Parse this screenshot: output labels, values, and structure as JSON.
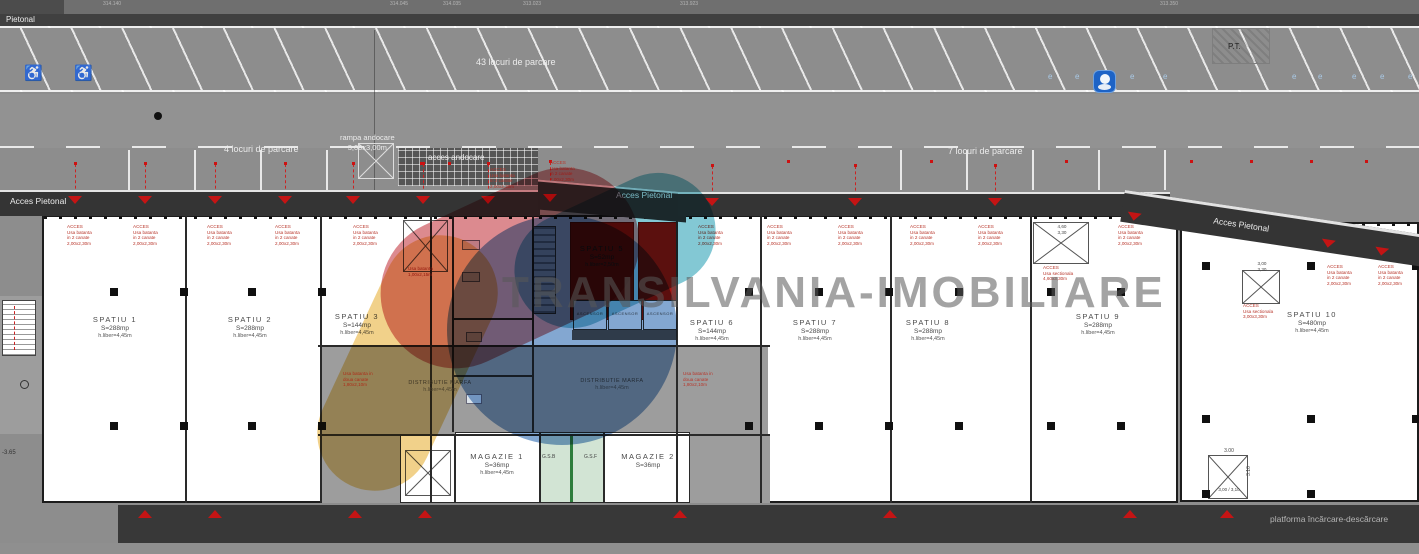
{
  "watermark": {
    "text": "TRANSILVANIA-IMOBILIARE",
    "colors": {
      "yellow": "#e8b33c",
      "red": "#c43c44",
      "blue": "#2f6cb3",
      "teal": "#2fa3b8"
    }
  },
  "site": {
    "pietonal_top": "Pietonal",
    "parking_top": "43 locuri de parcare",
    "parking_left": "4 locuri de parcare",
    "parking_right": "7 locuri de parcare",
    "ramp_line1": "rampa andocare",
    "ramp_line2": "3,00x3,00m",
    "dock_label": "acces andocare",
    "pt_label": "P.T.",
    "e_marker": "e",
    "access_left": "Acces Pietonal",
    "access_center": "Acces Pietonal",
    "access_right": "Acces Pietonal",
    "platform_label": "platforma încărcare-descărcare",
    "level_label": "-3.65",
    "elevation_marks": [
      "314.140",
      "314.045",
      "314.035",
      "313.023",
      "313.923",
      "313.350"
    ]
  },
  "spaces": [
    {
      "name": "SPATIU 1",
      "area": "S=288mp",
      "clearance": "h.liber=4,45m"
    },
    {
      "name": "SPATIU 2",
      "area": "S=288mp",
      "clearance": "h.liber=4,45m"
    },
    {
      "name": "SPATIU 3",
      "area": "S=144mp",
      "clearance": "h.liber=4,45m"
    },
    {
      "name": "SPATIU 5",
      "area": "S=52mp",
      "clearance": "h.liber=2,50m"
    },
    {
      "name": "SPATIU 6",
      "area": "S=144mp",
      "clearance": "h.liber=4,45m"
    },
    {
      "name": "SPATIU 7",
      "area": "S=288mp",
      "clearance": "h.liber=4,45m"
    },
    {
      "name": "SPATIU 8",
      "area": "S=288mp",
      "clearance": "h.liber=4,45m"
    },
    {
      "name": "SPATIU 9",
      "area": "S=288mp",
      "clearance": "h.liber=4,45m"
    },
    {
      "name": "SPATIU 10",
      "area": "S=480mp",
      "clearance": "h.liber=4,45m"
    }
  ],
  "service_rooms": {
    "magazie1": {
      "name": "MAGAZIE 1",
      "area": "S=36mp",
      "clearance": "h.liber=4,45m"
    },
    "magazie2": {
      "name": "MAGAZIE 2",
      "area": "S=36mp"
    },
    "gsb": "G.S.B",
    "gsf": "G.S.F",
    "ascensor": "ASCENSOR",
    "distributie_name": "DISTRIBUTIE MARFA",
    "distributie_clearance": "h.liber=4,45m"
  },
  "annotations": {
    "acces_double": [
      "ACCES",
      "Usa batanta",
      "in 2 canate",
      "2,00x2,30m"
    ],
    "acces_sectional_1": [
      "ACCES",
      "Usa sectionala",
      "4,60x3,30m"
    ],
    "acces_sectional_2": [
      "ACCES",
      "Usa sectionala",
      "3,00x3,30m"
    ],
    "usa_double": [
      "Usa batanta in",
      "doua canate",
      "1,80x2,10m"
    ],
    "usa_single": [
      "Usa batanta",
      "1,00x2,15m"
    ]
  },
  "dimensions": {
    "sec1_w": "4,60",
    "sec1_h": "3,30",
    "sec2_w": "3,00",
    "sec2_h": "3,30",
    "dock3_w": "3.00",
    "dock3_h": "3.10",
    "dock3_label": "3,00 / 3,10"
  }
}
